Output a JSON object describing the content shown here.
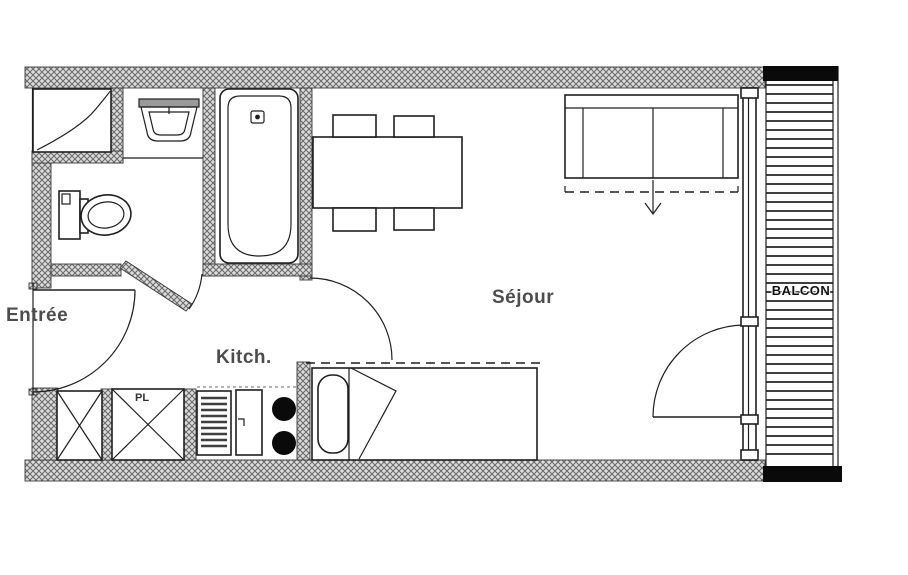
{
  "title": "Studio apartment floor plan",
  "labels": {
    "entrance": "Entrée",
    "kitchen": "Kitch.",
    "living_room": "Séjour",
    "balcony": "BALCON",
    "closet": "PL"
  },
  "colors": {
    "background": "#ffffff",
    "line": "#1f1f1f",
    "wall_fill": "#dcdcdc",
    "wall_hatch": "#6b6b6b",
    "label_text": "#4d4d4d",
    "balcony_label_text": "#111111",
    "slat": "#3f3f3f"
  },
  "furniture": [
    "wardrobe",
    "washbasin",
    "toilet",
    "bathtub",
    "dining-table",
    "chairs",
    "sofa-bed",
    "single-bed",
    "kitchen-units",
    "hob-burners",
    "balcony-decking",
    "entrance-door",
    "bathroom-door",
    "kitchen-door-swing",
    "balcony-door",
    "window-wall"
  ]
}
